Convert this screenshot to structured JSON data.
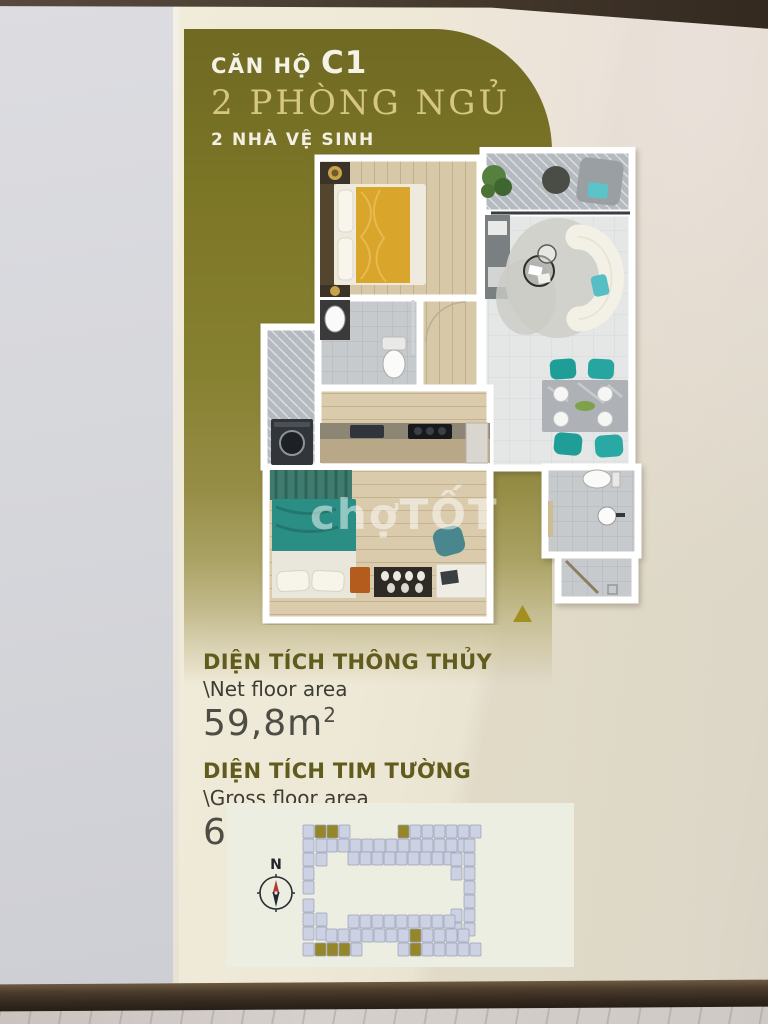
{
  "poster": {
    "title": {
      "prefix": "CĂN HỘ",
      "unit_code": "C1",
      "bedrooms_line": "2 PHÒNG NGỦ",
      "bathrooms_line": "2 NHÀ VỆ SINH"
    },
    "areas": [
      {
        "label_vi": "DIỆN TÍCH THÔNG THỦY",
        "label_en": "\\Net floor area",
        "value": "59,8m",
        "sup": "2"
      },
      {
        "label_vi": "DIỆN TÍCH TIM TƯỜNG",
        "label_en": "\\Gross floor area",
        "value": "65,6m",
        "sup": "2"
      }
    ],
    "watermark": "chợTỐT",
    "colors": {
      "olive_panel": "#7d7727",
      "gold_accent": "#a38f1f",
      "cream_board": "#ece6d4",
      "teal_furniture": "#27a5a0",
      "yellow_bed": "#d9a62b"
    }
  },
  "site_plan": {
    "compass_label": "N",
    "unit_color": "#ccd1e4",
    "highlight_color": "#958729",
    "stroke_color": "#9ba1b5",
    "rows": [
      {
        "x": 77,
        "y": 22,
        "cells": "LGGL"
      },
      {
        "x": 172,
        "y": 22,
        "cells": "GLLLLLL"
      },
      {
        "x": 100,
        "y": 36,
        "cells": "LLLLLLLLLLLL"
      },
      {
        "x": 122,
        "y": 49,
        "cells": "LLLLLLLLL"
      },
      {
        "x": 77,
        "y": 36,
        "dir": "v",
        "cells": "LLLL"
      },
      {
        "x": 90,
        "y": 36,
        "dir": "v",
        "cells": "LL"
      },
      {
        "x": 238,
        "y": 36,
        "dir": "v",
        "cells": "LLLL"
      },
      {
        "x": 225,
        "y": 50,
        "dir": "v",
        "cells": "LL"
      },
      {
        "x": 77,
        "y": 96,
        "dir": "v",
        "cells": "LLL"
      },
      {
        "x": 90,
        "y": 110,
        "dir": "v",
        "cells": "LL"
      },
      {
        "x": 238,
        "y": 92,
        "dir": "v",
        "cells": "LLL"
      },
      {
        "x": 225,
        "y": 106,
        "dir": "v",
        "cells": "LL"
      },
      {
        "x": 122,
        "y": 112,
        "cells": "LLLLLLLLL"
      },
      {
        "x": 100,
        "y": 126,
        "cells": "LLLLLLLGLLLL"
      },
      {
        "x": 77,
        "y": 140,
        "cells": "LGGGL"
      },
      {
        "x": 172,
        "y": 140,
        "cells": "LGLLLLL"
      }
    ]
  }
}
